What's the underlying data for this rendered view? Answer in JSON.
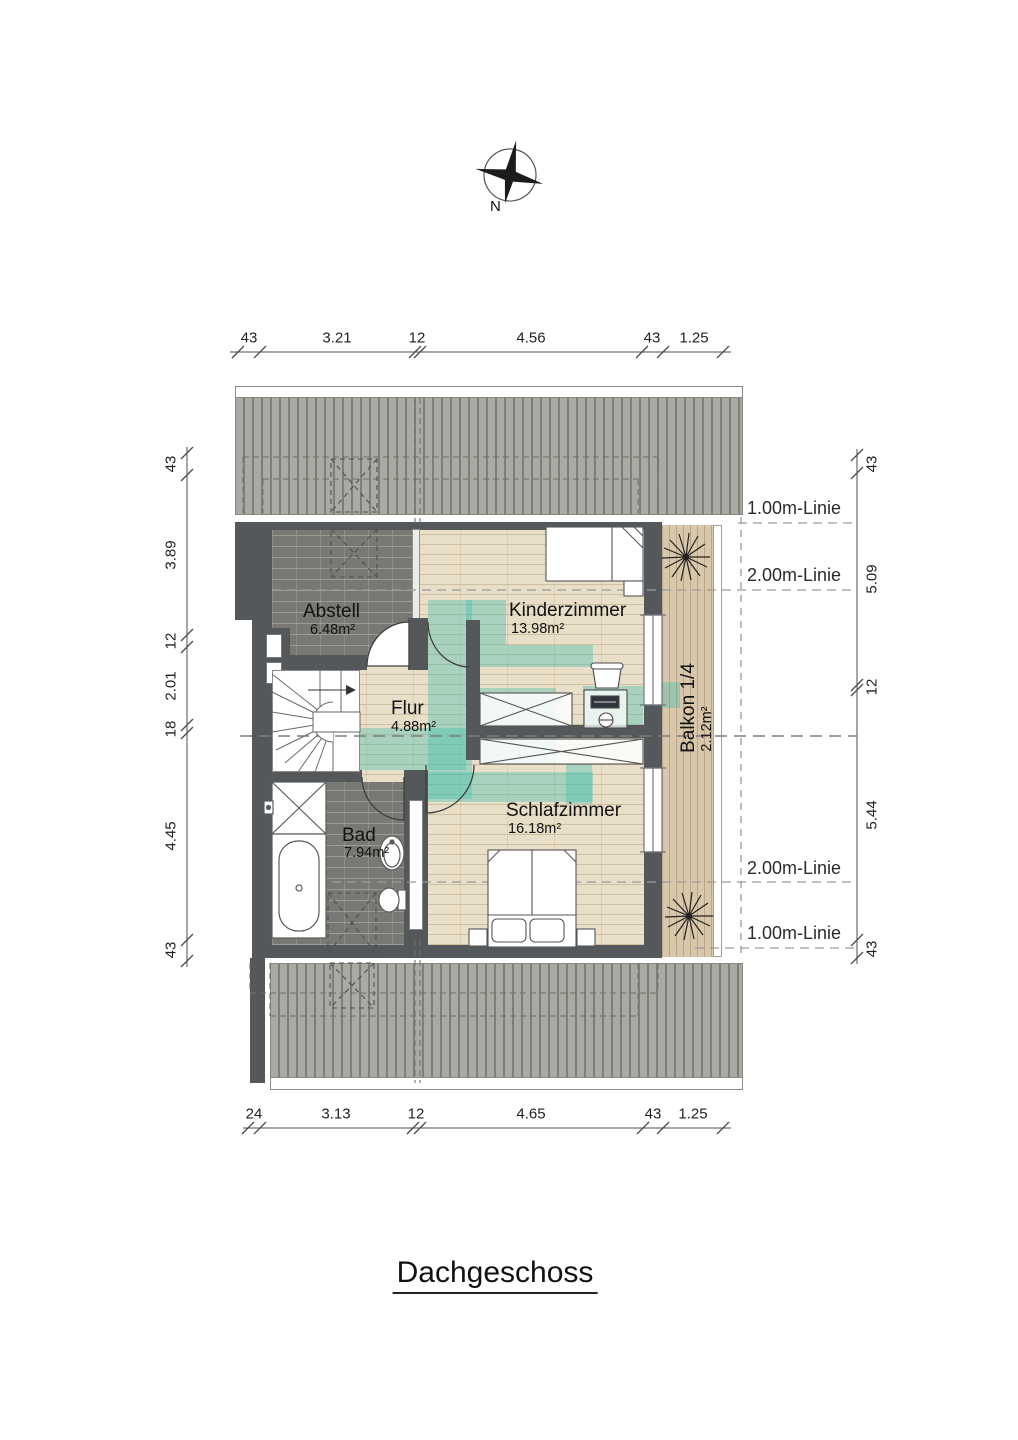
{
  "title": "Dachgeschoss",
  "compass": {
    "north_label": "N"
  },
  "dims": {
    "top": [
      "43",
      "3.21",
      "12",
      "4.56",
      "43",
      "1.25"
    ],
    "bottom": [
      "24",
      "3.13",
      "12",
      "4.65",
      "43",
      "1.25"
    ],
    "left": [
      "43",
      "3.89",
      "12",
      "2.01",
      "18",
      "4.45",
      "43"
    ],
    "right": [
      "43",
      "5.09",
      "12",
      "5.44",
      "43"
    ]
  },
  "height_lines": {
    "top_1m": "1.00m-Linie",
    "top_2m": "2.00m-Linie",
    "bottom_2m": "2.00m-Linie",
    "bottom_1m": "1.00m-Linie"
  },
  "rooms": {
    "abstell": {
      "name": "Abstell",
      "area": "6.48m²"
    },
    "kinderzimmer": {
      "name": "Kinderzimmer",
      "area": "13.98m²"
    },
    "flur": {
      "name": "Flur",
      "area": "4.88m²"
    },
    "bad": {
      "name": "Bad",
      "area": "7.94m²"
    },
    "schlafzimmer": {
      "name": "Schlafzimmer",
      "area": "16.18m²"
    },
    "balkon": {
      "name": "Balkon 1/4",
      "area": "2.12m²"
    }
  },
  "colors": {
    "wall": "#54585b",
    "roof_stripe": "#7c7f77",
    "roof_base": "#a8aba3",
    "wood_floor": "#e9dfc9",
    "tile_floor": "#7a7874",
    "balcony_deck": "#d8c7aa",
    "highlight_teal": "#3ebcad"
  }
}
